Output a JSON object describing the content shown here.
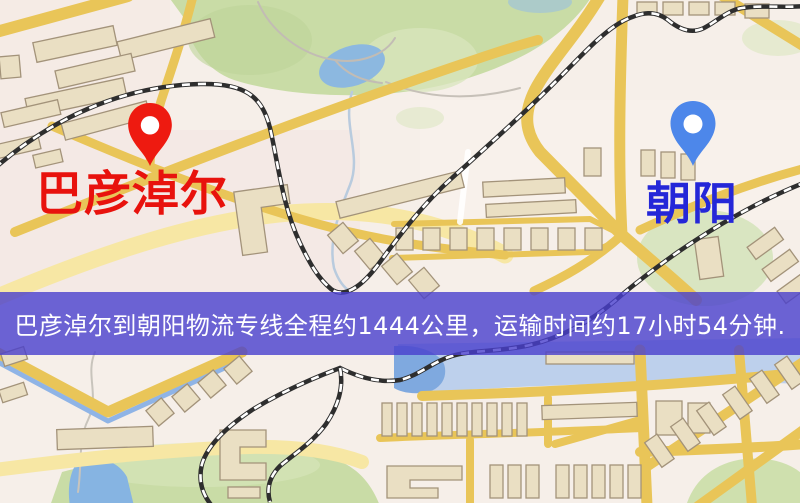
{
  "map": {
    "origin": {
      "label": "巴彦淖尔",
      "pin_icon": "red-pin-icon",
      "pin_color": "#ee1a10",
      "label_color": "#e8120d"
    },
    "destination": {
      "label": "朝阳",
      "pin_icon": "blue-pin-icon",
      "pin_color": "#4d87ea",
      "label_color": "#2527d8"
    },
    "banner": {
      "text": "巴彦淖尔到朝阳物流专线全程约1444公里，运输时间约17小时54分钟.",
      "bg_color": "rgba(72,63,205,0.8)",
      "text_color": "#ffffff"
    },
    "route": {
      "distance_km": 1444,
      "duration_hours": 17,
      "duration_minutes": 54
    },
    "palette": {
      "background": "#f6efe9",
      "road_yellow": "#e9c558",
      "road_pale": "#f7e7a4",
      "park_green": "#c9dca6",
      "water_blue": "#86b4e2",
      "railway_dark": "#2e2e2e",
      "building_fill": "#eadfc3",
      "building_stroke": "#a3937a"
    }
  }
}
